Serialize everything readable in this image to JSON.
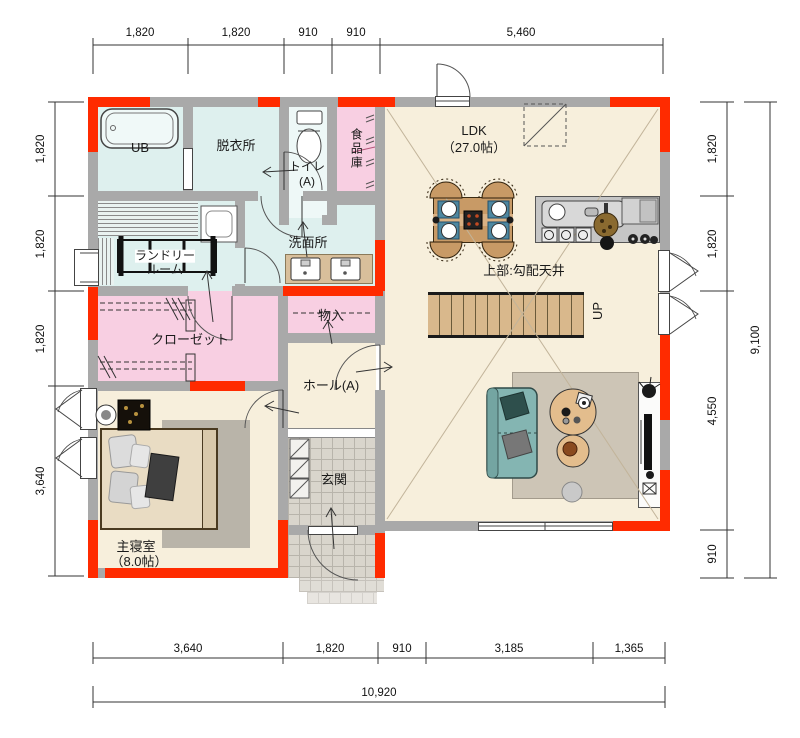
{
  "dimensions": {
    "top": [
      "1,820",
      "1,820",
      "910",
      "910",
      "5,460"
    ],
    "left": [
      "1,820",
      "1,820",
      "1,820",
      "3,640"
    ],
    "right": [
      "1,820",
      "1,820",
      "4,550",
      "910"
    ],
    "right_total": "9,100",
    "bottom": [
      "3,640",
      "1,820",
      "910",
      "3,185",
      "1,365"
    ],
    "bottom_total": "10,920"
  },
  "rooms": {
    "ub": {
      "label": "UB"
    },
    "dressing": {
      "label": "脱衣所"
    },
    "toilet": {
      "label": "トイレ",
      "suffix": "(A)"
    },
    "pantry": {
      "label": "食品庫"
    },
    "ldk": {
      "label": "LDK",
      "size": "（27.0帖）"
    },
    "washroom": {
      "label": "洗面所"
    },
    "laundry": {
      "line1": "ランドリー",
      "line2": "ルーム"
    },
    "closet": {
      "label": "クローゼット"
    },
    "storage": {
      "label": "物入"
    },
    "hall": {
      "label": "ホール(A)"
    },
    "genkan": {
      "label": "玄関"
    },
    "bedroom": {
      "label": "主寝室",
      "size": "（8.0帖）"
    }
  },
  "annotations": {
    "ceiling": "上部:勾配天井",
    "stairs_up": "UP"
  },
  "colors": {
    "accent_red": "#ff2b00",
    "floor_cream": "#f7efdc",
    "room_cyan": "#def0ee",
    "room_pink": "#f8cfe2",
    "wall_gray": "#a9a9a9"
  }
}
